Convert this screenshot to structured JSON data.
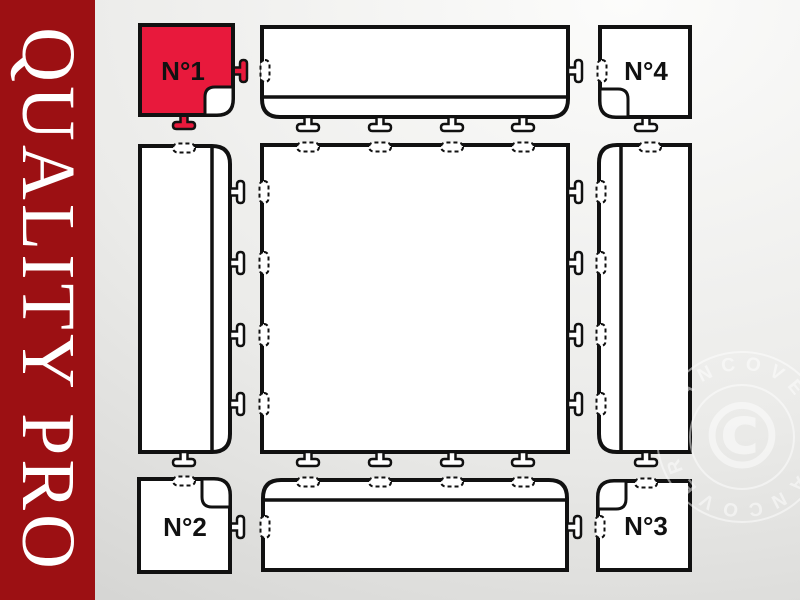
{
  "banner": {
    "text": "QUALITY PRO",
    "bg_color": "#9C1013",
    "text_color": "#FFFFFF"
  },
  "diagram": {
    "outline_color": "#111111",
    "highlight_color": "#E8193C",
    "corner_tiles": [
      {
        "label": "N°1",
        "fill": "#E8193C",
        "position": "top-left",
        "highlighted": true
      },
      {
        "label": "N°2",
        "fill": "#FFFFFF",
        "position": "bottom-left",
        "highlighted": false
      },
      {
        "label": "N°3",
        "fill": "#FFFFFF",
        "position": "bottom-right",
        "highlighted": false
      },
      {
        "label": "N°4",
        "fill": "#FFFFFF",
        "position": "top-right",
        "highlighted": false
      }
    ],
    "edge_pieces": [
      "top",
      "left",
      "right",
      "bottom"
    ],
    "center_tile": "main tile"
  },
  "watermark": {
    "symbol": "©",
    "circular_text": "DANCOVER",
    "color": "#FFFFFF"
  }
}
